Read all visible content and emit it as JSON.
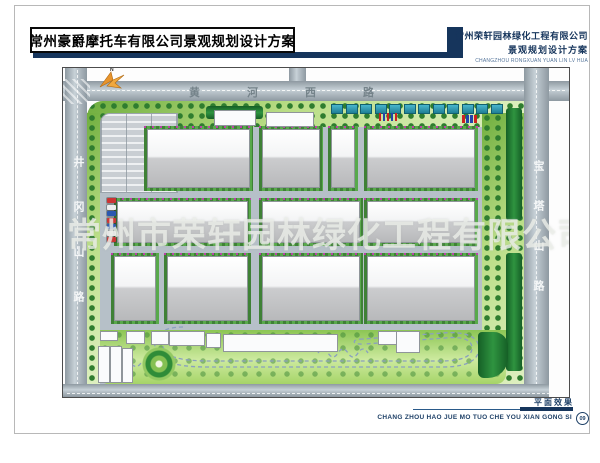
{
  "header": {
    "title": "常州豪爵摩托车有限公司景观规划设计方案",
    "company_name": "常州荣轩园林绿化工程有限公司",
    "company_subtitle": "景观规划设计方案",
    "company_pinyin": "CHANGZHOU RONGXUAN YUAN LIN LV HUA"
  },
  "footer": {
    "caption": "平面效果",
    "pinyin": "CHANG ZHOU HAO JUE MO TUO CHE YOU XIAN GONG SI",
    "page_number": "09"
  },
  "map": {
    "watermark": "常州市荣轩园林绿化工程有限公司",
    "compass_label": "N",
    "roads": {
      "top": "黄河西路",
      "left": "井冈山路",
      "right": "宝塔山路"
    },
    "colors": {
      "navy": "#16355c",
      "road_gray": "#aab6bd",
      "site_gray": "#b6c0c8",
      "belt_green": "#9ccf5e",
      "dark_green": "#1f7c33",
      "hedge_green": "#4d9d42",
      "building_gray": "#c3c4c6",
      "track_blue": "#8aa0bf",
      "roof_teal": "#2f9fb8",
      "compass_orange": "#e8942c",
      "flower_magenta": "#c837b4"
    },
    "layout": {
      "factories": [
        [
          81,
          58,
          109,
          65
        ],
        [
          196,
          58,
          64,
          65
        ],
        [
          265,
          58,
          30,
          65
        ],
        [
          301,
          58,
          114,
          65
        ],
        [
          51,
          130,
          137,
          48
        ],
        [
          196,
          130,
          104,
          48
        ],
        [
          301,
          130,
          114,
          48
        ],
        [
          48,
          185,
          48,
          71
        ],
        [
          101,
          185,
          87,
          71
        ],
        [
          196,
          185,
          104,
          71
        ],
        [
          301,
          185,
          114,
          71
        ]
      ],
      "aux": [
        [
          151,
          42,
          40,
          14
        ],
        [
          203,
          44,
          46,
          13
        ],
        [
          37,
          263,
          16,
          8
        ],
        [
          63,
          263,
          17,
          11
        ],
        [
          88,
          263,
          16,
          12
        ],
        [
          106,
          263,
          34,
          13
        ],
        [
          143,
          265,
          13,
          13
        ],
        [
          160,
          266,
          113,
          16
        ],
        [
          315,
          263,
          40,
          12
        ],
        [
          333,
          263,
          22,
          20
        ],
        [
          35,
          278,
          10,
          35
        ],
        [
          47,
          278,
          10,
          35
        ],
        [
          59,
          280,
          9,
          33
        ]
      ],
      "dark_green": [
        [
          143,
          38,
          57,
          13
        ],
        [
          443,
          40,
          16,
          112
        ],
        [
          443,
          185,
          16,
          118
        ],
        [
          415,
          264,
          30,
          46
        ]
      ],
      "blue_roofs": {
        "count": 12,
        "x": 268,
        "y": 36,
        "step": 14.5,
        "w": 10,
        "h": 8
      },
      "flags": {
        "x": 316,
        "y": 45,
        "step": 4,
        "colors": [
          "#cc2222",
          "#2244aa",
          "#cc2222",
          "#2244aa",
          "#cc2222"
        ]
      },
      "cars_right": {
        "x": 399,
        "y": 47,
        "step": 4,
        "colors": [
          "#cc2222",
          "#2244aa",
          "#2244aa",
          "#cc2222"
        ]
      },
      "cars_left": {
        "x": 44,
        "y": 130,
        "step": 6.5,
        "colors": [
          "#cc3333",
          "#eeeeee",
          "#2a57b0",
          "#cc3333",
          "#2a57b0",
          "#eeeeee",
          "#cc3333"
        ]
      }
    }
  }
}
